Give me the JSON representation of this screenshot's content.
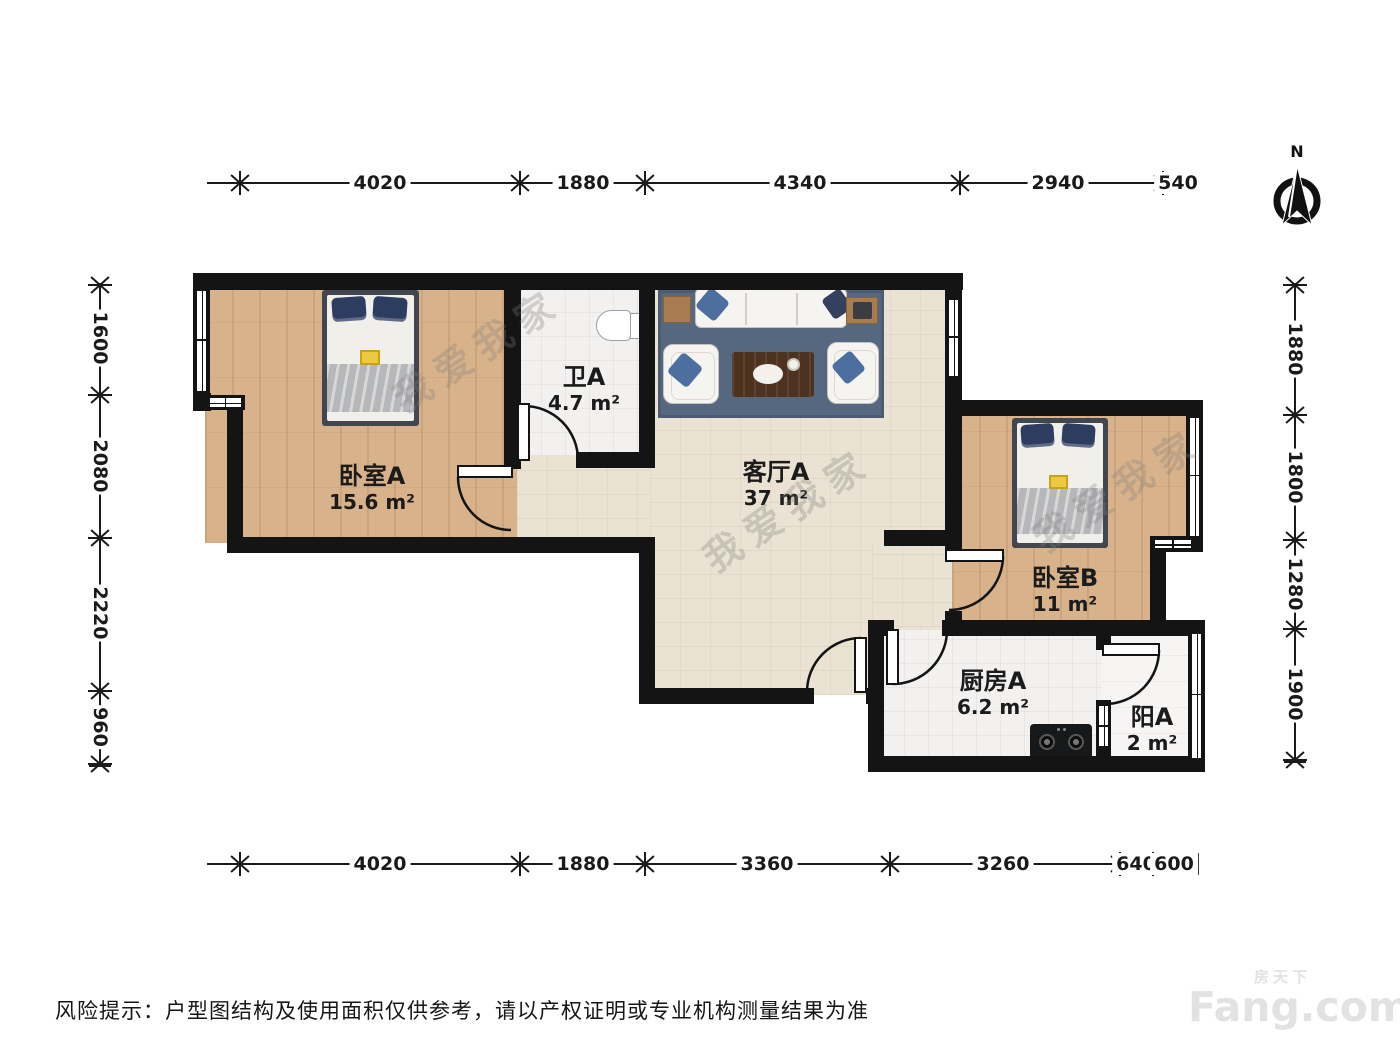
{
  "page": {
    "background": "#ffffff"
  },
  "compass": {
    "label": "N"
  },
  "rooms": [
    {
      "name": "卧室A",
      "area": "15.6 m²"
    },
    {
      "name": "卫A",
      "area": "4.7 m²"
    },
    {
      "name": "客厅A",
      "area": "37 m²"
    },
    {
      "name": "卧室B",
      "area": "11 m²"
    },
    {
      "name": "厨房A",
      "area": "6.2 m²"
    },
    {
      "name": "阳A",
      "area": "2 m²"
    }
  ],
  "dimensions": {
    "top": [
      "4020",
      "1880",
      "4340",
      "2940",
      "540"
    ],
    "bottom": [
      "4020",
      "1880",
      "3360",
      "3260",
      "640",
      "600"
    ],
    "left": [
      "1600",
      "2080",
      "2220",
      "960"
    ],
    "right": [
      "1880",
      "1800",
      "1280",
      "1900"
    ]
  },
  "watermark": {
    "text": "我爱我家"
  },
  "disclaimer": "风险提示：户型图结构及使用面积仅供参考，请以产权证明或专业机构测量结果为准",
  "logo": {
    "cn": "房天下",
    "en": "Fang.com"
  },
  "colors": {
    "wall": "#141414",
    "wood_floor": "#d8b28a",
    "living_floor": "#eae2d2",
    "tile_floor": "#f2f1ef",
    "rug": "#56687f",
    "bed_pillow": "#2d3d60",
    "accent_yellow": "#ecc93e"
  }
}
